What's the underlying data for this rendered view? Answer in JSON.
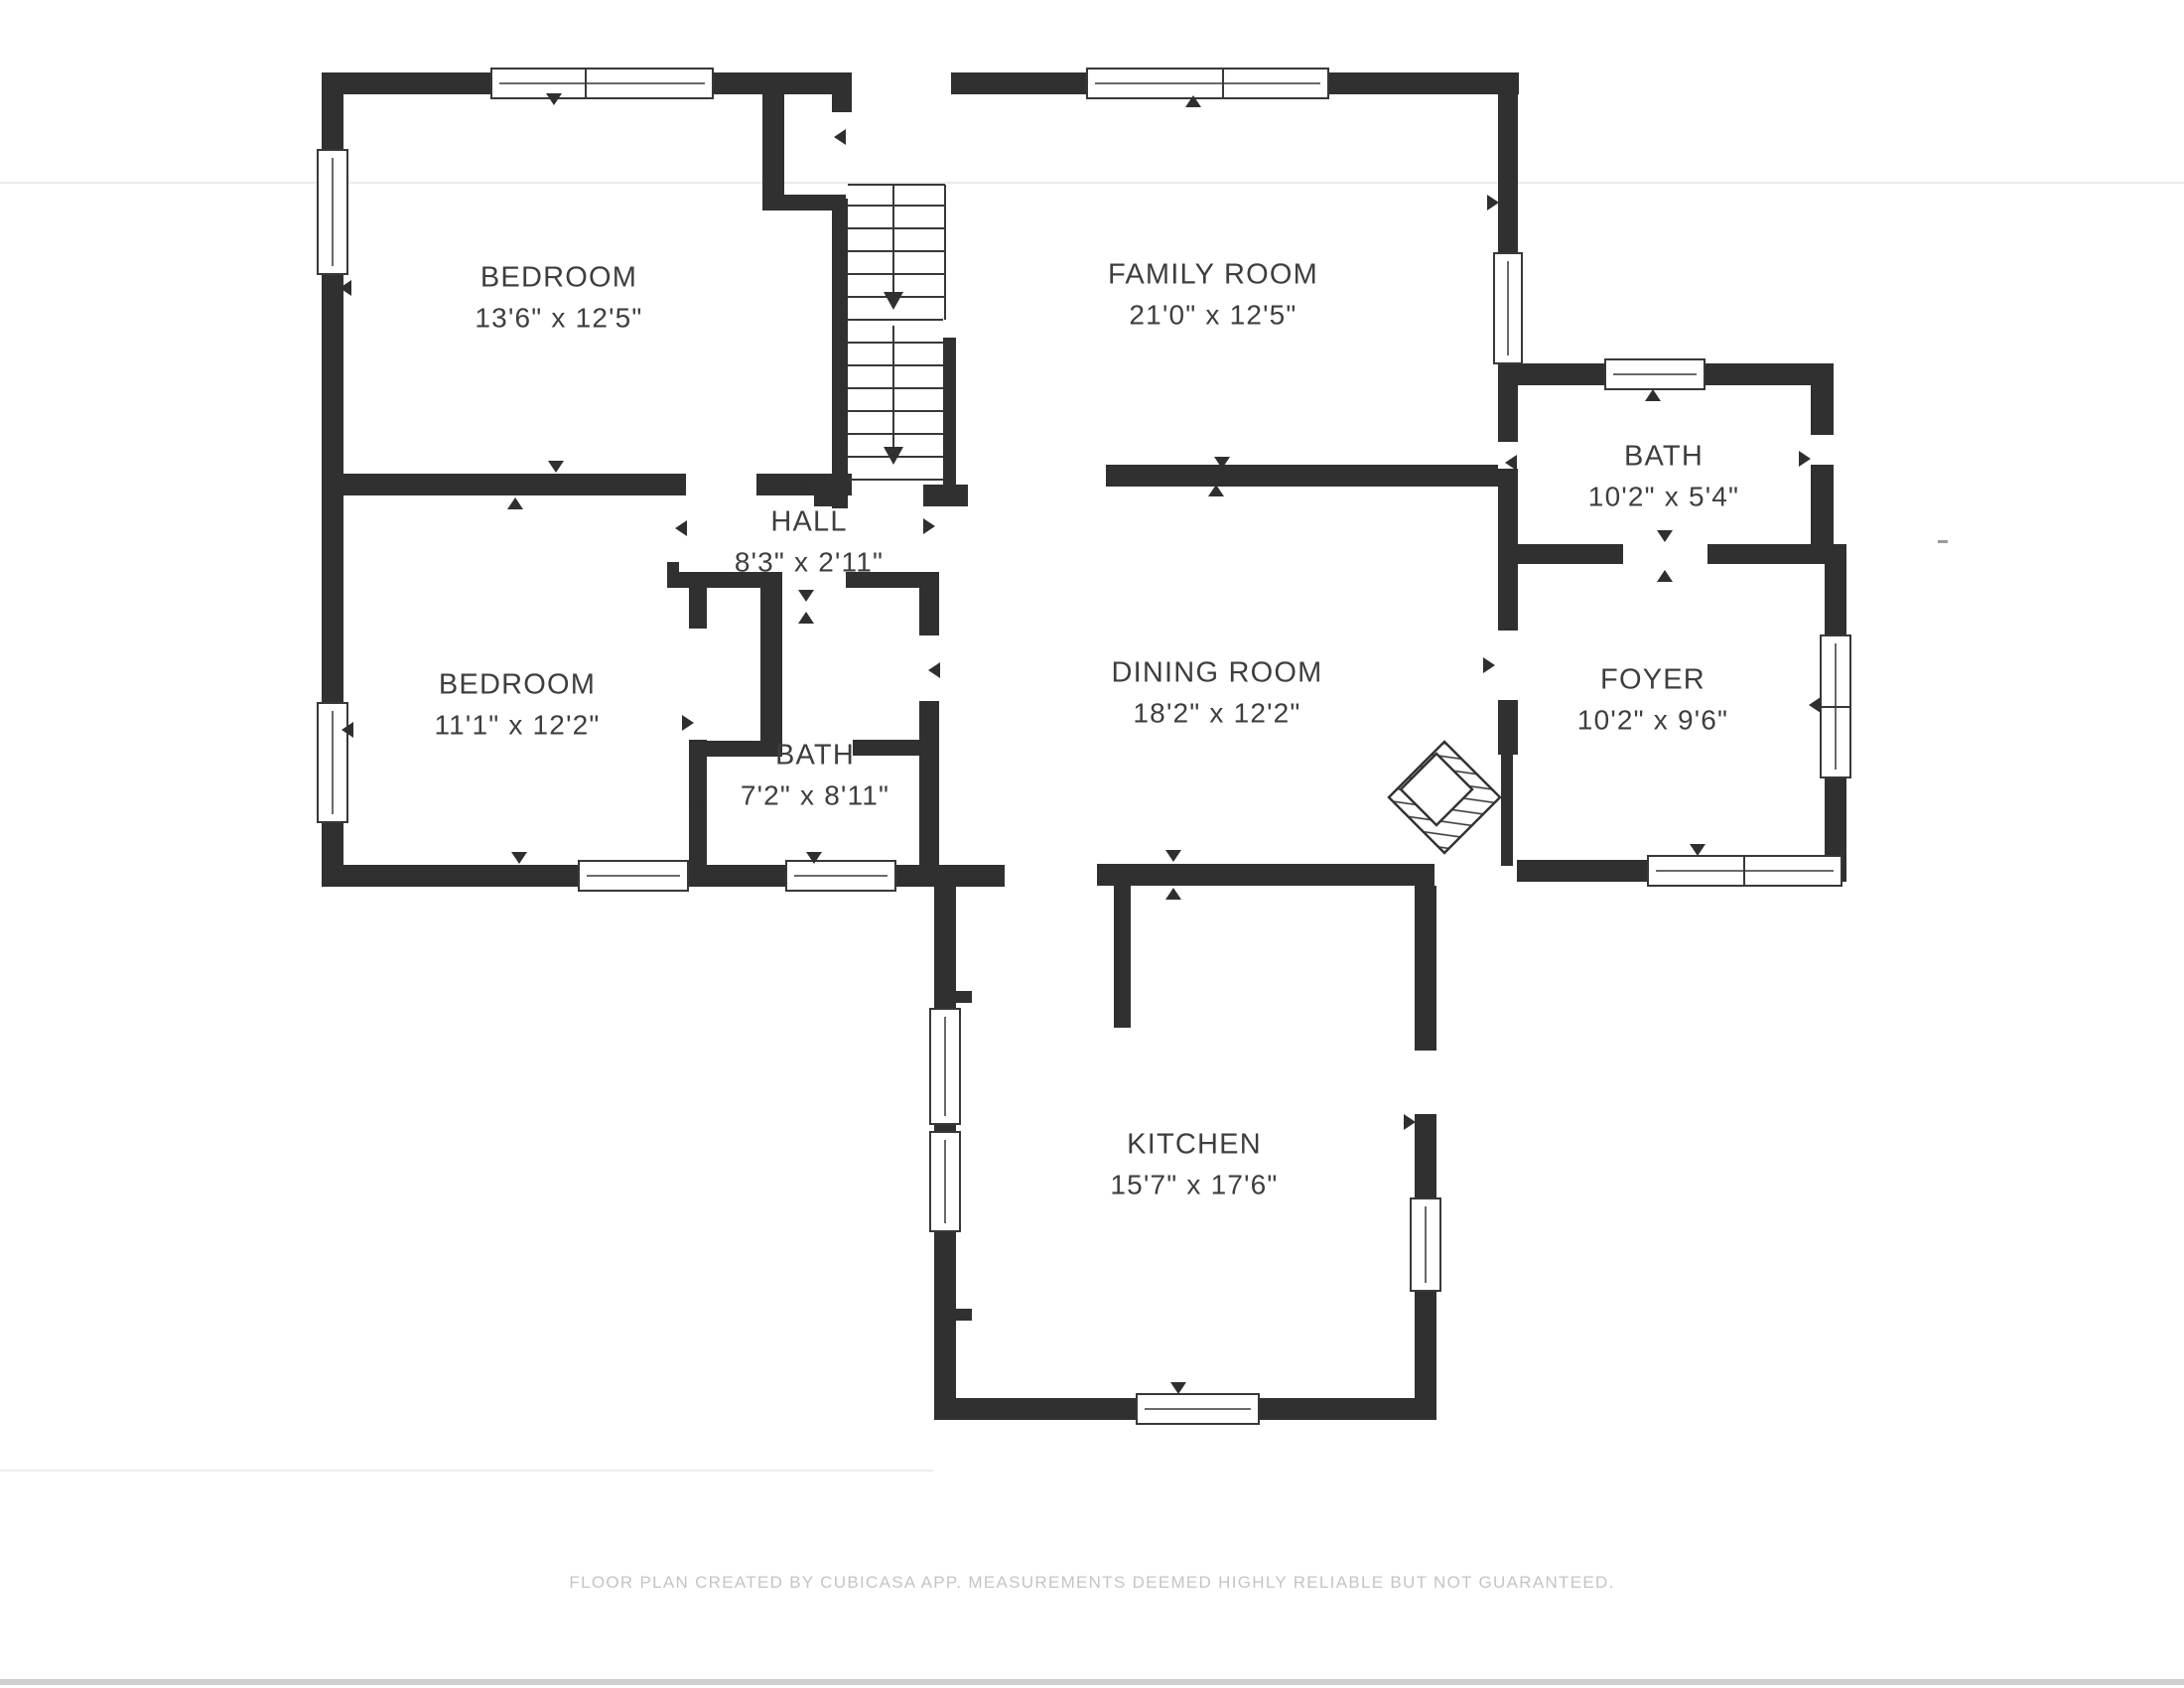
{
  "page": {
    "background": "#ffffff",
    "footer": "FLOOR PLAN CREATED BY CUBICASA APP. MEASUREMENTS DEEMED HIGHLY RELIABLE BUT NOT GUARANTEED."
  },
  "colors": {
    "wall": "#303030",
    "label_text": "#3e3e3e",
    "footer_text": "#c4c4c4"
  },
  "rooms": [
    {
      "id": "bedroom-1",
      "name": "BEDROOM",
      "dims": "13'6\" x 12'5\""
    },
    {
      "id": "family-room",
      "name": "FAMILY ROOM",
      "dims": "21'0\" x 12'5\""
    },
    {
      "id": "bath-upper",
      "name": "BATH",
      "dims": "10'2\" x 5'4\""
    },
    {
      "id": "hall",
      "name": "HALL",
      "dims": "8'3\" x 2'11\""
    },
    {
      "id": "bedroom-2",
      "name": "BEDROOM",
      "dims": "11'1\" x 12'2\""
    },
    {
      "id": "dining-room",
      "name": "DINING ROOM",
      "dims": "18'2\" x 12'2\""
    },
    {
      "id": "foyer",
      "name": "FOYER",
      "dims": "10'2\" x 9'6\""
    },
    {
      "id": "bath-center",
      "name": "BATH",
      "dims": "7'2\" x 8'11\""
    },
    {
      "id": "kitchen",
      "name": "KITCHEN",
      "dims": "15'7\" x 17'6\""
    }
  ]
}
